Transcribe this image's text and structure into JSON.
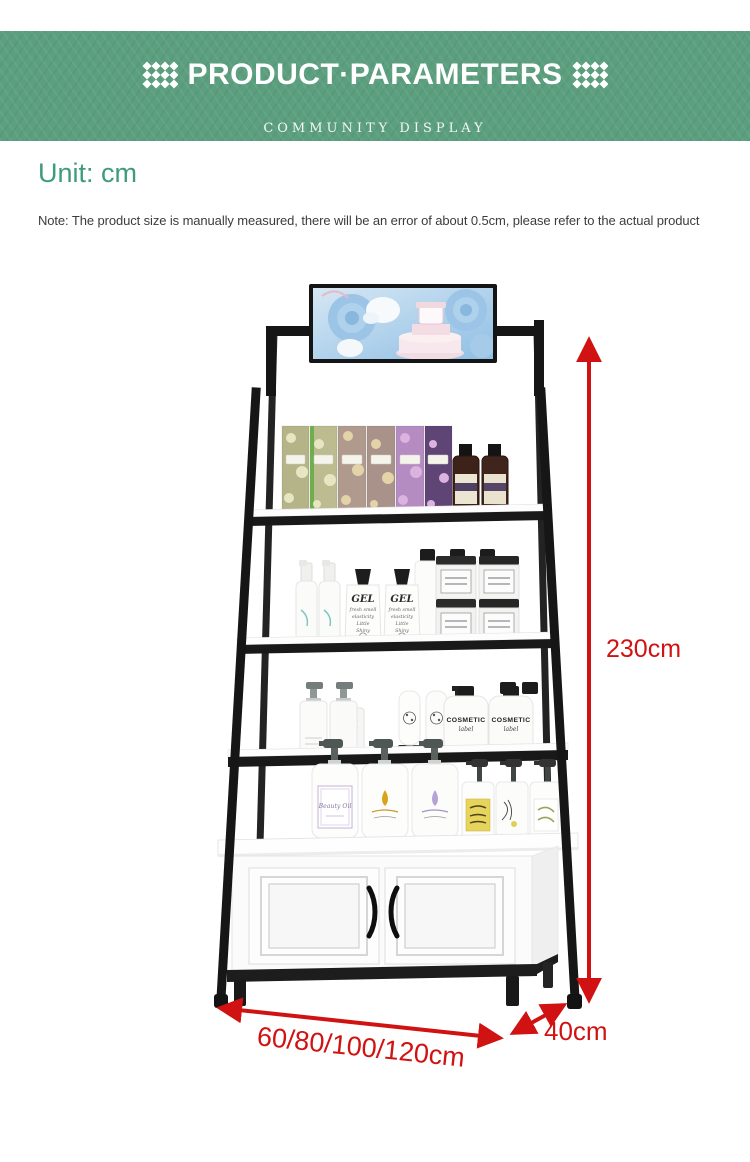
{
  "banner": {
    "title": "PRODUCT·PARAMETERS",
    "subtitle": "COMMUNITY DISPLAY",
    "bg_color": "#5c9f7f",
    "text_color": "#ffffff"
  },
  "info": {
    "unit_label": "Unit: cm",
    "unit_color": "#3e9c7d",
    "note": "Note: The product size is manually measured, there will be an error of about 0.5cm, please refer to the actual product",
    "note_color": "#3c3c3c"
  },
  "figure": {
    "frame_color": "#1a1a1a",
    "shelf_color": "#ffffff",
    "arrow_color": "#d11212",
    "dimensions": {
      "height": "230cm",
      "width": "60/80/100/120cm",
      "depth": "40cm"
    },
    "products": {
      "gel_bottle_label": {
        "title": "GEL",
        "lines": [
          "fresh smell",
          "elasticity",
          "Little",
          "Shiny"
        ]
      },
      "cosmetic_bottle_label": {
        "title": "COSMETIC",
        "subtitle": "label"
      },
      "beauty_oil_label": "Beauty Oil"
    }
  }
}
